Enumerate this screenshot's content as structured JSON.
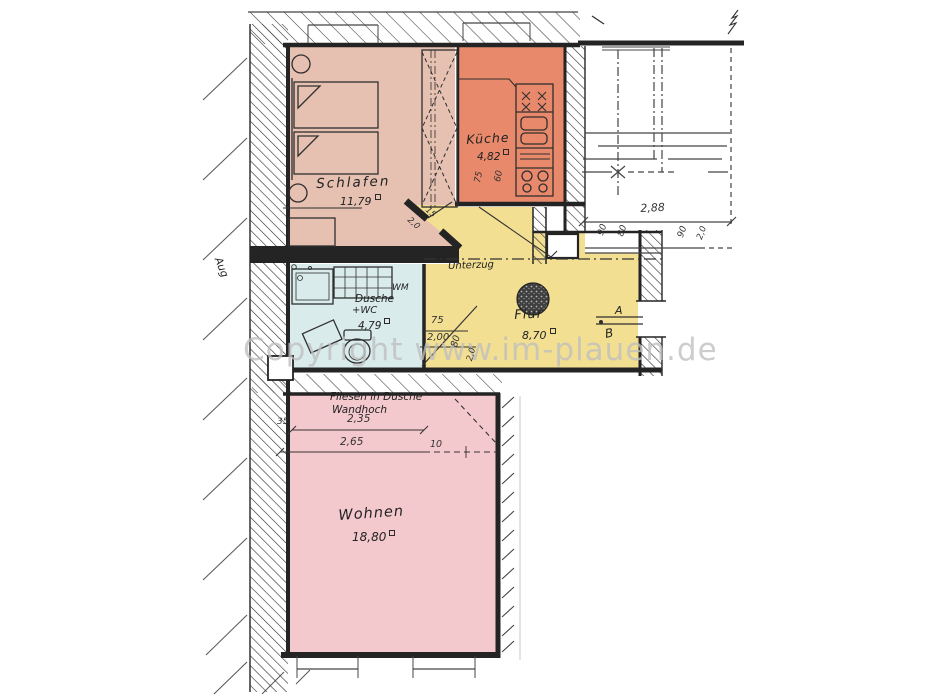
{
  "document": {
    "type": "hand-drawn floor plan scan",
    "watermark": "Copyright www.im-plauen.de",
    "area_unit": "m²"
  },
  "rooms": [
    {
      "label": "Schlafen",
      "area": "11,79"
    },
    {
      "label": "Küche",
      "area": "4,82"
    },
    {
      "label": "Dusche",
      "label2": "+WC",
      "area": "4,79"
    },
    {
      "label": "Flur",
      "area": "8,70"
    },
    {
      "label": "Wohnen",
      "area": "18,80"
    }
  ],
  "annotations": {
    "unterzug": "Unterzug",
    "fliesen_line1": "Fliesen in Dusche",
    "fliesen_line2": "Wandhoch",
    "washing_machine": "WM",
    "wall_note": "Aug",
    "section_a": "A",
    "section_b": "B"
  },
  "dimensions": {
    "stair_width": "2,88",
    "door_75": "75",
    "door_200": "2,00",
    "rot_80": "80",
    "rot_20": "2,0",
    "wohnen_235": "2,35",
    "wohnen_35": "35",
    "wohnen_265": "2,65",
    "wohnen_10": "10",
    "diag_15": "15",
    "diag_20": "2,0",
    "kitchen_75": "75",
    "kitchen_60": "60",
    "top_90a": "90",
    "top_80": "80",
    "top_90b": "90",
    "top_20": "2,0"
  },
  "colors": {
    "bedroom": "#e6c1b1",
    "kitchen": "#e8896b",
    "hall": "#f2df92",
    "bath": "#d9eceb",
    "living": "#f4c9cd",
    "wall": "#242424",
    "watermark": "#bfbfbf"
  }
}
